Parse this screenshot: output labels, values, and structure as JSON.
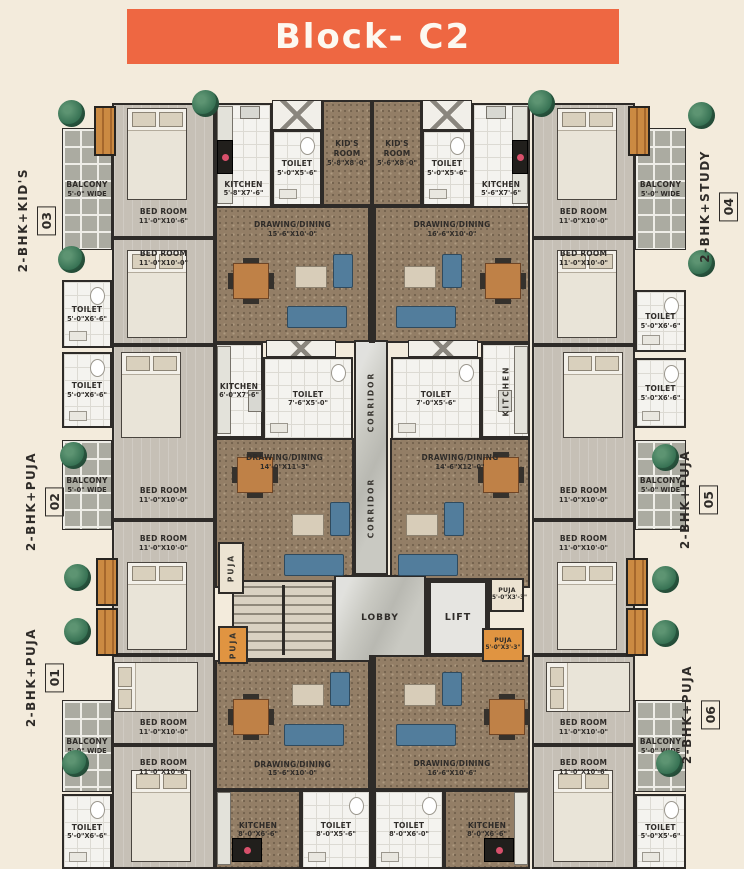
{
  "title": "Block- C2",
  "colors": {
    "banner_orange": "#ee6742",
    "background_cream": "#f3ebdc",
    "carpet_brown": "#937e66",
    "puja_orange": "#e09441",
    "tree_green": "#357052",
    "sofa_blue": "#527d9c",
    "wall_dark": "#2e2b28"
  },
  "side_labels": {
    "left": [
      {
        "label": "2-BHK+KID'S",
        "number": "03"
      },
      {
        "label": "2-BHK+PUJA",
        "number": "02"
      },
      {
        "label": "2-BHK+PUJA",
        "number": "01"
      }
    ],
    "right": [
      {
        "label": "2-BHK+STUDY",
        "number": "04"
      },
      {
        "label": "2-BHK+PUJA",
        "number": "05"
      },
      {
        "label": "2-BHK+PUJA",
        "number": "06"
      }
    ]
  },
  "rooms": {
    "u3_balcony": {
      "name": "BALCONY",
      "dim": "5'-0\" WIDE"
    },
    "u3_toilet_a": {
      "name": "TOILET",
      "dim": "5'-0\"X6'-6\""
    },
    "u2_toilet_a": {
      "name": "TOILET",
      "dim": "5'-0\"X6'-6\""
    },
    "u2_balcony": {
      "name": "BALCONY",
      "dim": "5'-0\" WIDE"
    },
    "u1_balcony": {
      "name": "BALCONY",
      "dim": "5'-0\" WIDE"
    },
    "u1_toilet_a": {
      "name": "TOILET",
      "dim": "5'-0\"X6'-6\""
    },
    "u4_balcony": {
      "name": "BALCONY",
      "dim": "5'-0\" WIDE"
    },
    "u4_toilet_a": {
      "name": "TOILET",
      "dim": "5'-0\"X6'-6\""
    },
    "u5_toilet_a": {
      "name": "TOILET",
      "dim": "5'-0\"X6'-6\""
    },
    "u5_balcony": {
      "name": "BALCONY",
      "dim": "5'-0\" WIDE"
    },
    "u6_balcony": {
      "name": "BALCONY",
      "dim": "5'-0\" WIDE"
    },
    "u6_toilet_a": {
      "name": "TOILET",
      "dim": "5'-0\"X5'-6\""
    },
    "u3_bed1": {
      "name": "BED ROOM",
      "dim": "11'-0\"X10'-6\""
    },
    "u3_bed2": {
      "name": "BED ROOM",
      "dim": "11'-0\"X10'-0\""
    },
    "u2_bed1": {
      "name": "BED ROOM",
      "dim": "11'-0\"X10'-0\""
    },
    "u2_bed2": {
      "name": "BED ROOM",
      "dim": "11'-0\"X10'-0\""
    },
    "u1_bed1": {
      "name": "BED ROOM",
      "dim": "11'-0\"X10'-0\""
    },
    "u1_bed2": {
      "name": "BED ROOM",
      "dim": "11'-0\"X10'-6\""
    },
    "u4_bed1": {
      "name": "BED ROOM",
      "dim": "11'-0\"X10'-0\""
    },
    "u4_bed2": {
      "name": "BED ROOM",
      "dim": "11'-0\"X10'-0\""
    },
    "u5_bed1": {
      "name": "BED ROOM",
      "dim": "11'-0\"X10'-0\""
    },
    "u5_bed2": {
      "name": "BED ROOM",
      "dim": "11'-0\"X10'-0\""
    },
    "u6_bed1": {
      "name": "BED ROOM",
      "dim": "11'-0\"X10'-0\""
    },
    "u6_bed2": {
      "name": "BED ROOM",
      "dim": "11'-0\"X10'-6\""
    },
    "u3_kitchen": {
      "name": "KITCHEN",
      "dim": "5'-8\"X7'-6\""
    },
    "u4_kitchen": {
      "name": "KITCHEN",
      "dim": "5'-6\"X7'-6\""
    },
    "u3_toilet_b": {
      "name": "TOILET",
      "dim": "5'-0\"X5'-6\""
    },
    "u4_toilet_b": {
      "name": "TOILET",
      "dim": "5'-0\"X5'-6\""
    },
    "u3_kids": {
      "name": "KID'S ROOM",
      "dim": "5'-8\"X8'-0\""
    },
    "u4_kids": {
      "name": "KID'S ROOM",
      "dim": "5'-6\"X8'-0\""
    },
    "u3_drawing": {
      "name": "DRAWING/DINING",
      "dim": "15'-6\"X10'-0\""
    },
    "u4_drawing": {
      "name": "DRAWING/DINING",
      "dim": "16'-6\"X10'-0\""
    },
    "u2_kitchen": {
      "name": "KITCHEN",
      "dim": "6'-0\"X7'-6\""
    },
    "u5_kitchen": {
      "name": "KITCHEN",
      "dim": ""
    },
    "u2_toilet_b": {
      "name": "TOILET",
      "dim": "7'-6\"X5'-0\""
    },
    "u5_toilet_b": {
      "name": "TOILET",
      "dim": "7'-0\"X5'-6\""
    },
    "u2_drawing": {
      "name": "DRAWING/DINING",
      "dim": "14'-0\"X11'-3\""
    },
    "u5_drawing": {
      "name": "DRAWING/DINING",
      "dim": "14'-6\"X12'-0\""
    },
    "u2_puja": {
      "name": "PUJA",
      "dim": ""
    },
    "u1_puja": {
      "name": "PUJA",
      "dim": ""
    },
    "u5_puja": {
      "name": "PUJA",
      "dim": "5'-0\"X3'-3\""
    },
    "u6_puja": {
      "name": "PUJA",
      "dim": "5'-0\"X3'-3\""
    },
    "corridor_a": {
      "name": "CORRIDOR",
      "dim": ""
    },
    "corridor_b": {
      "name": "CORRIDOR",
      "dim": ""
    },
    "lobby": {
      "name": "LOBBY",
      "dim": ""
    },
    "lift": {
      "name": "LIFT",
      "dim": ""
    },
    "u1_drawing": {
      "name": "DRAWING/DINING",
      "dim": "15'-6\"X10'-0\""
    },
    "u6_drawing": {
      "name": "DRAWING/DINING",
      "dim": "16'-6\"X10'-6\""
    },
    "u1_kitchen": {
      "name": "KITCHEN",
      "dim": "8'-0\"X6'-6\""
    },
    "u6_kitchen": {
      "name": "KITCHEN",
      "dim": "8'-0\"X6'-6\""
    },
    "u1_toilet_b": {
      "name": "TOILET",
      "dim": "8'-0\"X5'-6\""
    },
    "u6_toilet_b": {
      "name": "TOILET",
      "dim": "8'-0\"X6'-0\""
    }
  }
}
